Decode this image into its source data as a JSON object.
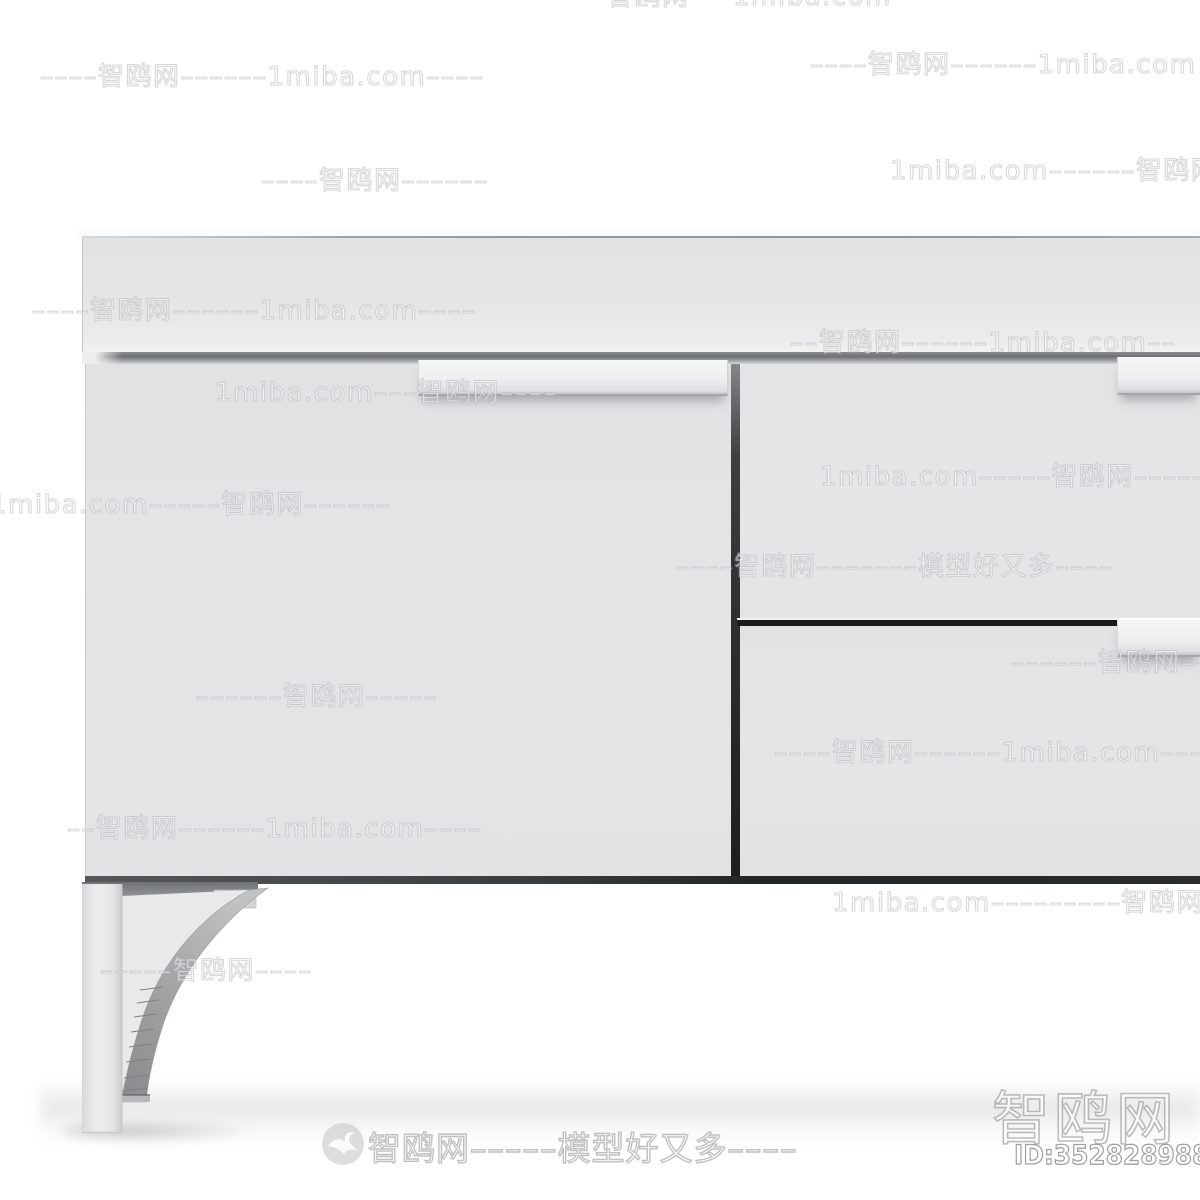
{
  "watermarks": {
    "tiles": [
      {
        "x": 520,
        "y": -18,
        "text": "––––––智鸥网–––1miba.com––––––"
      },
      {
        "x": 40,
        "y": 62,
        "text": "––––智鸥网––––––1miba.com––––"
      },
      {
        "x": 810,
        "y": 50,
        "text": "––––智鸥网––––––1miba.com"
      },
      {
        "x": 261,
        "y": 166,
        "text": "––––智鸥网––––––"
      },
      {
        "x": 890,
        "y": 156,
        "text": "1miba.com––––––智鸥网––"
      },
      {
        "x": 32,
        "y": 296,
        "text": "––––智鸥网––––––1miba.com––––"
      },
      {
        "x": 790,
        "y": 328,
        "text": "––智鸥网––––––1miba.com––"
      },
      {
        "x": 215,
        "y": 378,
        "text": "1miba.com–––智鸥网––––"
      },
      {
        "x": -10,
        "y": 490,
        "text": "1miba.com–––––智鸥网––––––"
      },
      {
        "x": 820,
        "y": 462,
        "text": "1miba.com–––––智鸥网––––––"
      },
      {
        "x": 676,
        "y": 552,
        "text": "––––智鸥网–––––––模型好又多––––"
      },
      {
        "x": 196,
        "y": 682,
        "text": "––––––智鸥网–––––"
      },
      {
        "x": 1011,
        "y": 648,
        "text": "––––––智鸥网––"
      },
      {
        "x": 774,
        "y": 738,
        "text": "––––智鸥网––––––1miba.com––––"
      },
      {
        "x": 67,
        "y": 814,
        "text": "––智鸥网––––––1miba.com––––"
      },
      {
        "x": 832,
        "y": 888,
        "text": "1miba.com–––––––––智鸥网––"
      },
      {
        "x": 100,
        "y": 956,
        "text": "–––––智鸥网––––"
      }
    ],
    "footer": {
      "logo": "seagull-in-circle",
      "text": "智鸥网–––––模型好又多––––"
    },
    "badge": {
      "site": "智鸥网",
      "model_id": "ID:352828988"
    }
  },
  "colors": {
    "background": "#ffffff",
    "cabinet_panel": "#e4e5e6",
    "door_panel": "#e3e4e6",
    "groove_dark": "#6e7174",
    "gap_dark": "#1d1e1f",
    "handle": "#eeefef",
    "leg": "#e9eaeb",
    "floor_shadow": "#d4d6d8",
    "watermark_stroke": "rgba(160,163,167,0.42)"
  }
}
